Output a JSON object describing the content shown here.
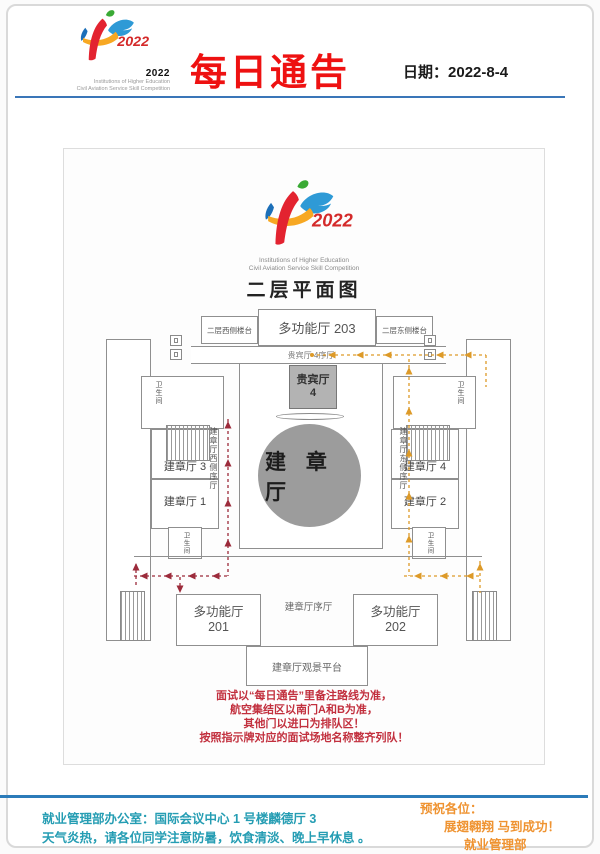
{
  "header": {
    "title": "每日通告",
    "date_label": "日期：",
    "date_value": "2022-8-4",
    "logo_year": "2022",
    "logo_year_bold": "2022",
    "logo_sub1": "Institutions of Higher Education",
    "logo_sub2": "Civil Aviation Service Skill Competition"
  },
  "plan": {
    "title": "二层平面图",
    "logo_sub1": "Institutions of Higher Education",
    "logo_sub2": "Civil Aviation Service Skill Competition",
    "rooms": {
      "west_balcony": "二层西侧楼台",
      "multi203": "多功能厅 203",
      "east_balcony": "二层东侧楼台",
      "vip4_lobby": "贵宾厅 4序厅",
      "vip4_l1": "贵宾厅",
      "vip4_l2": "4",
      "main_hall": "建 章 厅",
      "jz3": "建章厅 3",
      "jz1": "建章厅 1",
      "jz4": "建章厅 4",
      "jz2": "建章厅 2",
      "west_corridor": "建章厅西侧序厅",
      "east_corridor": "建章厅东侧序厅",
      "toilet": "卫生间",
      "multi201_l1": "多功能厅",
      "multi201_l2": "201",
      "multi202_l1": "多功能厅",
      "multi202_l2": "202",
      "jz_lobby": "建章厅序厅",
      "platform": "建章厅观景平台"
    },
    "notice": [
      "面试以“每日通告”里备注路线为准，",
      "航空集结区以南门A和B为准，",
      "其他门以进口为排队区！",
      "按照指示牌对应的面试场地名称整齐列队！"
    ],
    "colors": {
      "route_west": "#9c2b3b",
      "route_east": "#dd9a28",
      "hall_fill": "#9c9c9c",
      "vip_fill": "#b3b3b3"
    }
  },
  "footer": {
    "office": "就业管理部办公室：国际会议中心 1 号楼麟德厅 3",
    "weather": "天气炎热，请各位同学注意防暑，饮食清淡、晚上早休息 。",
    "wish1": "预祝各位：",
    "wish2": "展翅翱翔  马到成功！",
    "wish3": "就业管理部"
  }
}
